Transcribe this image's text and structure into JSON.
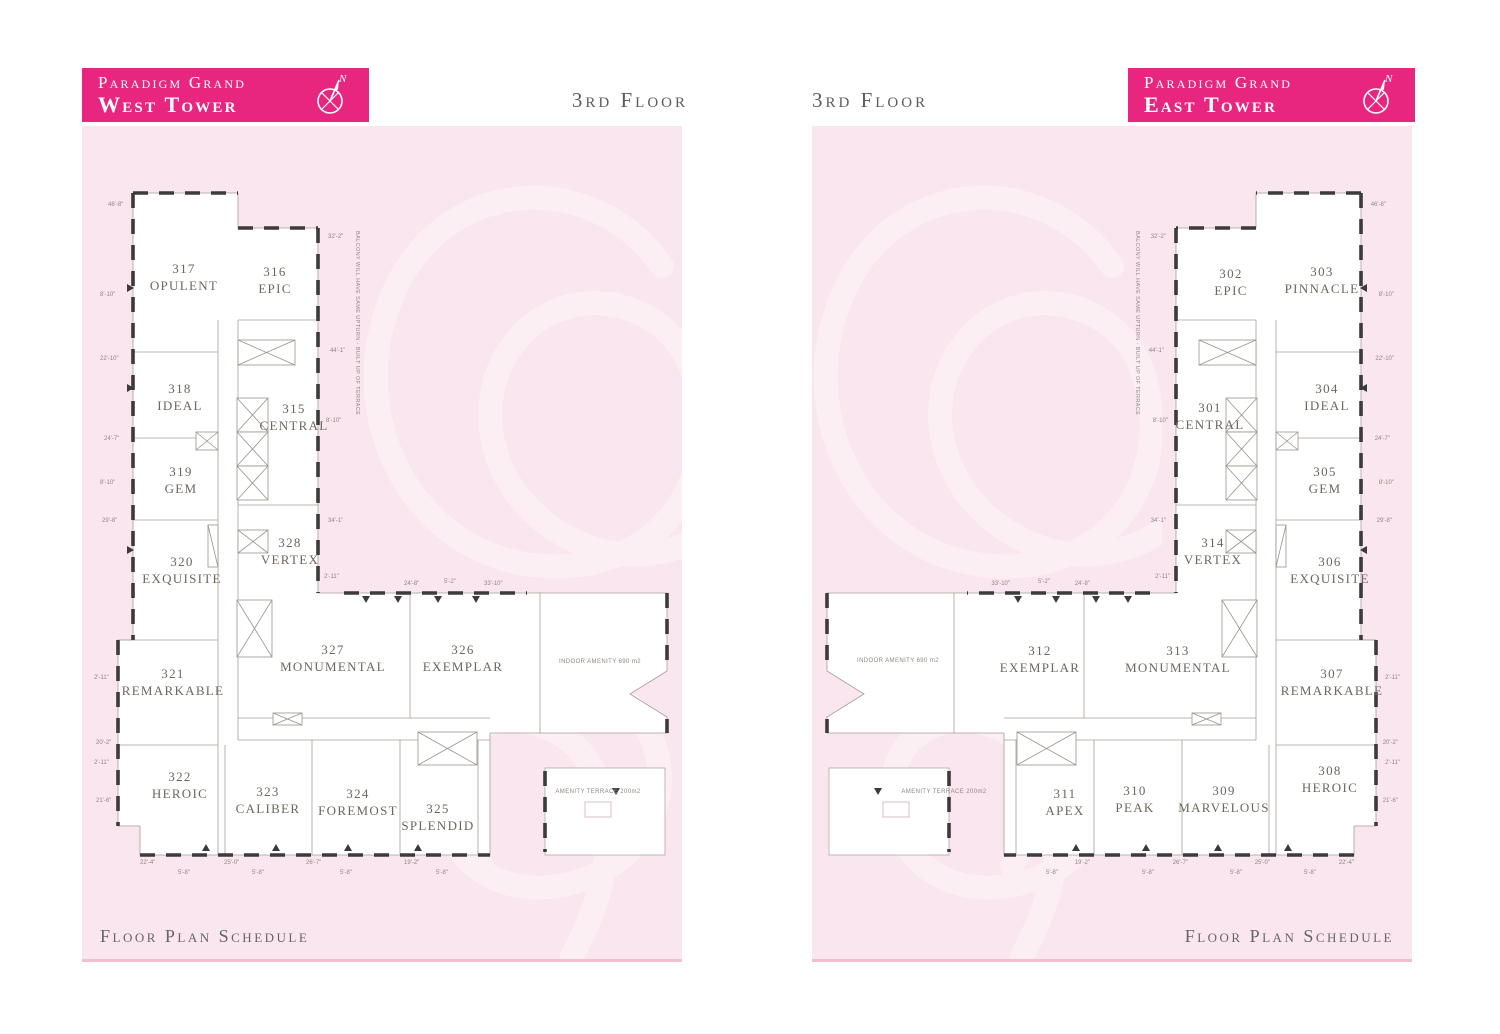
{
  "document": {
    "floor_label": "3rd Floor",
    "footer_label": "Floor Plan Schedule",
    "brand": "Paradigm Grand"
  },
  "west": {
    "header": {
      "brand": "Paradigm Grand",
      "tower": "West Tower"
    },
    "units": [
      {
        "number": "317",
        "name": "OPULENT"
      },
      {
        "number": "316",
        "name": "EPIC"
      },
      {
        "number": "318",
        "name": "IDEAL"
      },
      {
        "number": "315",
        "name": "CENTRAL"
      },
      {
        "number": "319",
        "name": "GEM"
      },
      {
        "number": "328",
        "name": "VERTEX"
      },
      {
        "number": "320",
        "name": "EXQUISITE"
      },
      {
        "number": "321",
        "name": "REMARKABLE"
      },
      {
        "number": "327",
        "name": "MONUMENTAL"
      },
      {
        "number": "326",
        "name": "EXEMPLAR"
      },
      {
        "number": "322",
        "name": "HEROIC"
      },
      {
        "number": "323",
        "name": "CALIBER"
      },
      {
        "number": "324",
        "name": "FOREMOST"
      },
      {
        "number": "325",
        "name": "SPLENDID"
      }
    ],
    "amenities": {
      "indoor": "INDOOR AMENITY 690 m2",
      "terrace": "AMENITY TERRACE 200m2"
    }
  },
  "east": {
    "header": {
      "brand": "Paradigm Grand",
      "tower": "East Tower"
    },
    "units": [
      {
        "number": "302",
        "name": "EPIC"
      },
      {
        "number": "303",
        "name": "PINNACLE"
      },
      {
        "number": "301",
        "name": "CENTRAL"
      },
      {
        "number": "304",
        "name": "IDEAL"
      },
      {
        "number": "305",
        "name": "GEM"
      },
      {
        "number": "314",
        "name": "VERTEX"
      },
      {
        "number": "306",
        "name": "EXQUISITE"
      },
      {
        "number": "312",
        "name": "EXEMPLAR"
      },
      {
        "number": "313",
        "name": "MONUMENTAL"
      },
      {
        "number": "307",
        "name": "REMARKABLE"
      },
      {
        "number": "311",
        "name": "APEX"
      },
      {
        "number": "310",
        "name": "PEAK"
      },
      {
        "number": "309",
        "name": "MARVELOUS"
      },
      {
        "number": "308",
        "name": "HEROIC"
      }
    ],
    "amenities": {
      "indoor": "INDOOR AMENITY 690 m2",
      "terrace": "AMENITY TERRACE 200m2"
    }
  },
  "side_note": "BALCONY WILL HAVE SAME UPTURN - BUILT UP OF TERRACE",
  "compass": {
    "north_label": "N",
    "icon": "compass-north-icon"
  },
  "dimensions": [
    "46'-8\"",
    "8'-10\"",
    "22'-10\"",
    "24'-7\"",
    "29'-8\"",
    "2'-11\"",
    "20'-2\"",
    "21'-6\"",
    "32'-2\"",
    "44'-1\"",
    "34'-1\"",
    "24'-8\"",
    "5'-2\"",
    "33'-10\"",
    "22'-4\"",
    "5'-8\"",
    "25'-0\"",
    "26'-7\"",
    "19'-2\""
  ],
  "colors": {
    "accent_magenta": "#E82680",
    "panel_pink": "#FAE6EE",
    "watermark_pink": "#FCEFF4",
    "border_pink": "#F3BDD2",
    "wall_dark": "#3B3B3B",
    "line_gray": "#A89F96",
    "text_gray": "#6D675F"
  }
}
